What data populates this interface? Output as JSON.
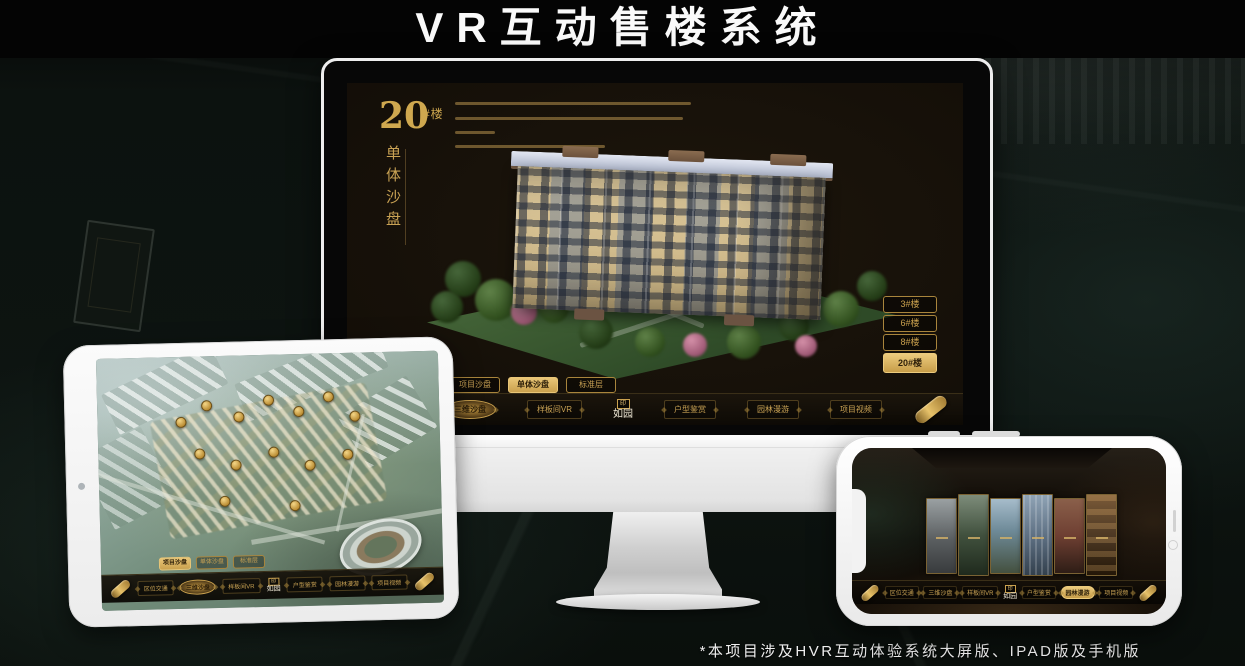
{
  "page": {
    "title": "VR互动售楼系统",
    "footnote": "*本项目涉及HVR互动体验系统大屏版、IPAD版及手机版"
  },
  "app": {
    "logo": "如园",
    "menu": [
      {
        "label": "区位交通"
      },
      {
        "label": "三维沙盘"
      },
      {
        "label": "样板间VR"
      },
      {
        "label": "户型鉴赏"
      },
      {
        "label": "园林漫游"
      },
      {
        "label": "项目视频"
      }
    ]
  },
  "desktop": {
    "heading": {
      "number": "20",
      "suffix": "#楼",
      "subtitle": "单体沙盘"
    },
    "tabs": [
      {
        "label": "项目沙盘",
        "active": false
      },
      {
        "label": "单体沙盘",
        "active": true
      },
      {
        "label": "标准层",
        "active": false
      }
    ],
    "floor_buttons": [
      {
        "label": "3#楼",
        "active": false
      },
      {
        "label": "6#楼",
        "active": false
      },
      {
        "label": "8#楼",
        "active": false
      },
      {
        "label": "20#楼",
        "active": true
      }
    ],
    "active_menu": "三维沙盘"
  },
  "tablet": {
    "tabs": [
      {
        "label": "项目沙盘",
        "active": true
      },
      {
        "label": "单体沙盘",
        "active": false
      },
      {
        "label": "标准层",
        "active": false
      }
    ],
    "active_menu": "三维沙盘"
  },
  "phone": {
    "active_menu": "园林漫游"
  },
  "colors": {
    "gold": "#d8b160",
    "gold_text": "#c9a254",
    "screen_bg": "#17120b",
    "accent_border": "#a9853c"
  }
}
